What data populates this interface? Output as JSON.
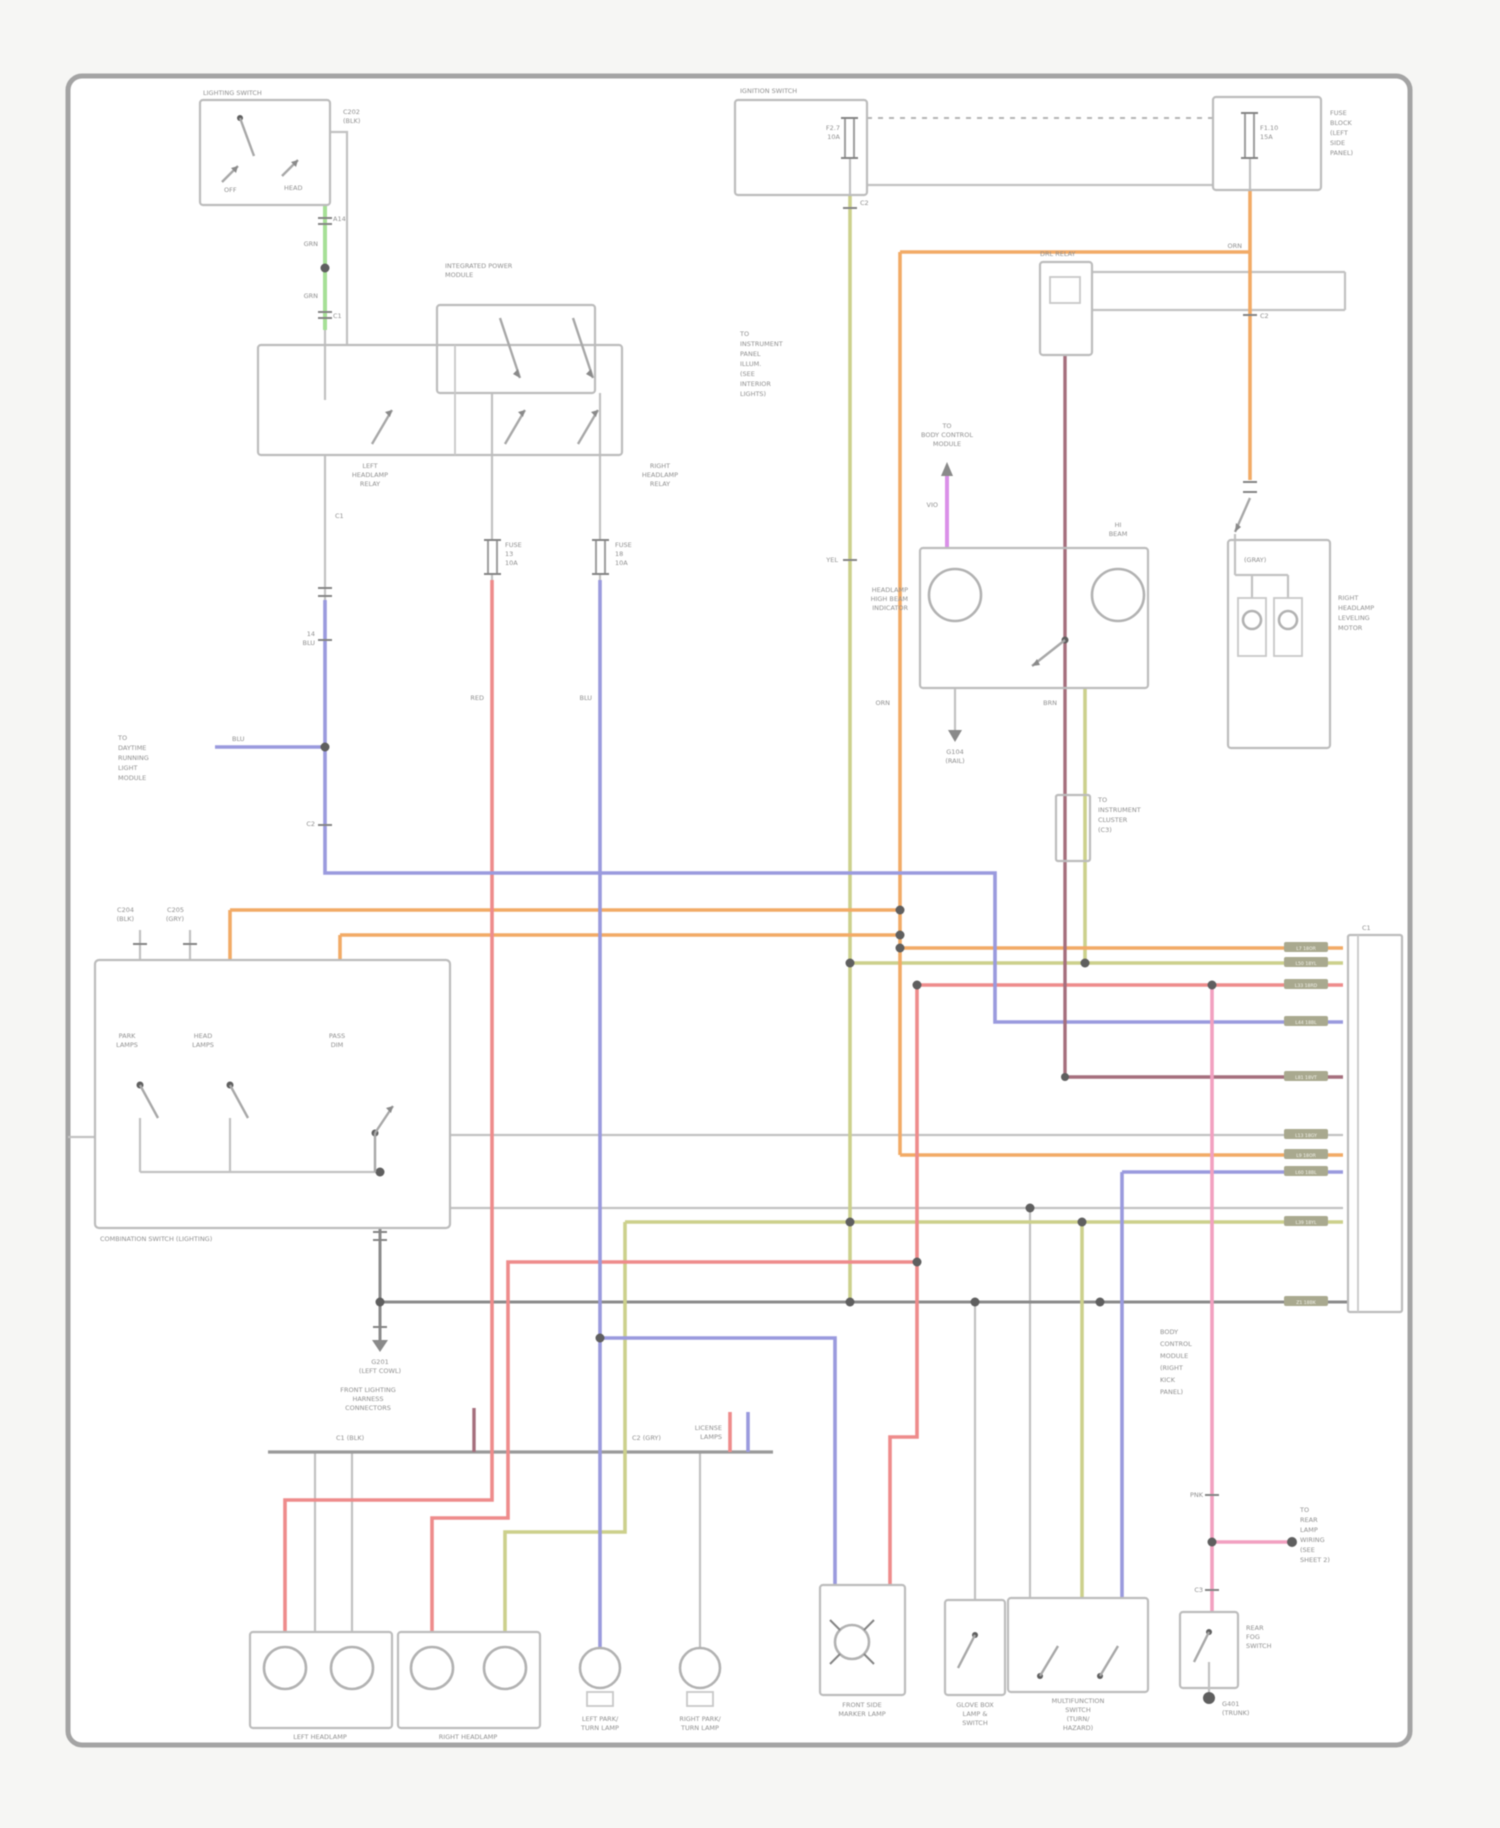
{
  "document": {
    "kind": "automotive wiring diagram scan",
    "sheet": "exterior lamps circuit"
  },
  "palette": {
    "page": "#ffffff",
    "frame": "#a4a4a4",
    "wire_green": "#a6e096",
    "wire_olive": "#ccd08c",
    "wire_orange": "#f2aa66",
    "wire_red": "#ee8b8b",
    "wire_maroon": "#a56f7d",
    "wire_blue": "#9a9ade",
    "wire_violet": "#da90e8",
    "wire_pink": "#f2a0c0",
    "wire_gray": "#c2c2c2",
    "text": "#8f8f8f"
  },
  "chips": [
    "L7 18OR",
    "L50 18YL",
    "L33 18RD",
    "L44 18BL",
    "L81 18VT",
    "L13 18GY",
    "L9 18OR",
    "L60 18BL",
    "L39 18YL",
    "Z1 18BK"
  ],
  "labels": {
    "lighting_switch": "LIGHTING SWITCH",
    "ls_conn": [
      "C202",
      "(BLK)"
    ],
    "a14": "A14",
    "grn1": "GRN",
    "grn2": "GRN",
    "c1a": "C1",
    "ipm": [
      "INTEGRATED POWER",
      "MODULE"
    ],
    "relay_left": [
      "LEFT",
      "HEADLAMP",
      "RELAY"
    ],
    "relay_right": [
      "RIGHT",
      "HEADLAMP",
      "RELAY"
    ],
    "fuse13": [
      "FUSE",
      "13",
      "10A"
    ],
    "fuse18": [
      "FUSE",
      "18",
      "10A"
    ],
    "c1b": "C1",
    "l14": [
      "14",
      "BLU"
    ],
    "wl_blu": "BLU",
    "c2a": "C2",
    "drl_module": [
      "TO",
      "DAYTIME",
      "RUNNING",
      "LIGHT",
      "MODULE"
    ],
    "ign": "IGNITION SWITCH",
    "ign_fuse": [
      "F2.7",
      "10A"
    ],
    "c2b": "C2",
    "fuseblock": [
      "FUSE",
      "BLOCK",
      "(LEFT",
      "SIDE",
      "PANEL)"
    ],
    "j_fuse": [
      "F1.10",
      "15A"
    ],
    "orn1": "ORN",
    "c2c": "C2",
    "drl_relay": "DRL RELAY",
    "leveling": [
      "RIGHT",
      "HEADLAMP",
      "LEVELING",
      "MOTOR"
    ],
    "cluster": [
      "TO",
      "INSTRUMENT",
      "CLUSTER",
      "(C3)"
    ],
    "illum": [
      "TO",
      "INSTRUMENT",
      "PANEL",
      "ILLUM.",
      "(SEE",
      "INTERIOR",
      "LIGHTS)"
    ],
    "yel1": "YEL",
    "orn2": "ORN",
    "red_lbl": "RED",
    "blue_lbl": "BLU",
    "mar_lbl": "BRN",
    "vio_to": [
      "TO",
      "BODY CONTROL",
      "MODULE"
    ],
    "vio": "VIO",
    "hibeam": [
      "HEADLAMP",
      "HIGH BEAM",
      "INDICATOR"
    ],
    "e_pin": [
      "HI",
      "BEAM"
    ],
    "g104": [
      "G104",
      "(RAIL)"
    ],
    "comb": "COMBINATION SWITCH (LIGHTING)",
    "comb_c1": [
      "C204",
      "(BLK)"
    ],
    "comb_c2": [
      "C205",
      "(GRY)"
    ],
    "sw1": [
      "PARK",
      "LAMPS"
    ],
    "sw2": [
      "HEAD",
      "LAMPS"
    ],
    "sw3": [
      "PASS",
      "DIM"
    ],
    "g201": [
      "G201",
      "(LEFT COWL)"
    ],
    "bar_label": [
      "FRONT LIGHTING",
      "HARNESS",
      "CONNECTORS"
    ],
    "bar_c1": "C1 (BLK)",
    "bar_c2": "C2 (GRY)",
    "lic": [
      "LICENSE",
      "LAMPS"
    ],
    "lh": "LEFT HEADLAMP",
    "rh": "RIGHT HEADLAMP",
    "lpark": [
      "LEFT PARK/",
      "TURN LAMP"
    ],
    "rpark": [
      "RIGHT PARK/",
      "TURN LAMP"
    ],
    "marker": [
      "FRONT SIDE",
      "MARKER LAMP"
    ],
    "glove": [
      "GLOVE BOX",
      "LAMP &",
      "SWITCH"
    ],
    "multi": [
      "MULTIFUNCTION",
      "SWITCH",
      "(TURN/",
      "HAZARD)"
    ],
    "bcm": [
      "BODY",
      "CONTROL",
      "MODULE",
      "(RIGHT",
      "KICK",
      "PANEL)"
    ],
    "pnk": "PNK",
    "c3": "C3",
    "rear_note": [
      "TO",
      "REAR",
      "LAMP",
      "WIRING",
      "(SEE",
      "SHEET 2)"
    ],
    "fog": [
      "REAR",
      "FOG",
      "SWITCH"
    ],
    "g401": [
      "G401",
      "(TRUNK)"
    ],
    "strip_c1": "C1",
    "d_label": "(GRAY)",
    "off": "OFF",
    "head": "HEAD"
  }
}
